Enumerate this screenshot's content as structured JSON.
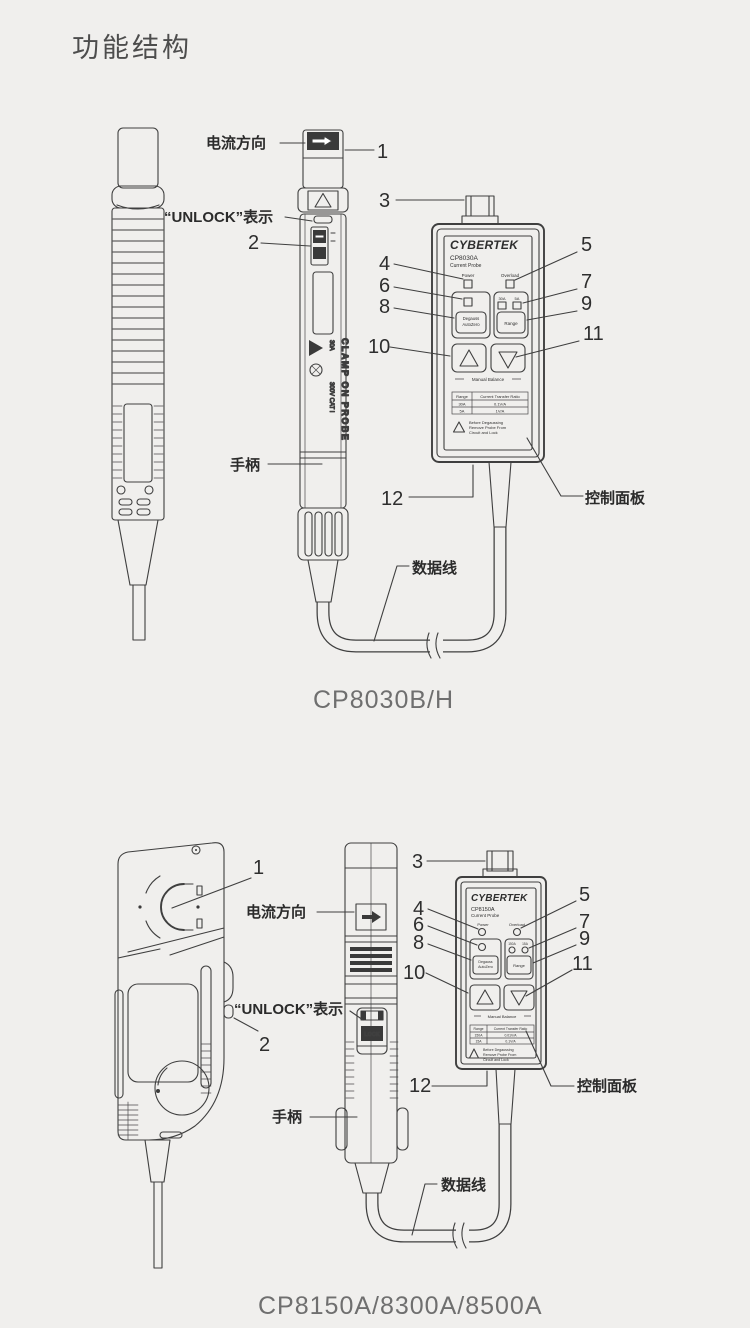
{
  "page": {
    "title": "功能结构"
  },
  "fig1": {
    "caption": "CP8030B/H",
    "labels": {
      "current_direction": "电流方向",
      "unlock": "“UNLOCK”表示",
      "handle": "手柄",
      "cable": "数据线",
      "control_panel": "控制面板"
    },
    "callouts": {
      "n1": "1",
      "n2": "2",
      "n3": "3",
      "n4": "4",
      "n5": "5",
      "n6": "6",
      "n7": "7",
      "n8": "8",
      "n9": "9",
      "n10": "10",
      "n11": "11",
      "n12": "12"
    },
    "probe": {
      "side_text": "CLAMP ON PROBE",
      "rating": "30A",
      "category": "300V CAT I"
    },
    "box": {
      "brand": "CYBERTEK",
      "model": "CP8030A",
      "type": "Current Probe",
      "power": "Power",
      "overload": "Overload",
      "range_led1": "30A",
      "range_led2": "5A",
      "degauss1": "Degauss",
      "degauss2": "AutoZero",
      "range_btn": "Range",
      "manual": "Manual Balance",
      "table": {
        "h1": "Range",
        "h2": "Current Transfer Ratio",
        "r1c1": "30A",
        "r1c2": "0.1V/A",
        "r2c1": "5A",
        "r2c2": "1V/A"
      },
      "warn1": "Before Degaussing",
      "warn2": "Remove Probe From",
      "warn3": "Circuit and Lock"
    }
  },
  "fig2": {
    "caption": "CP8150A/8300A/8500A",
    "labels": {
      "current_direction": "电流方向",
      "unlock": "“UNLOCK”表示",
      "handle": "手柄",
      "cable": "数据线",
      "control_panel": "控制面板"
    },
    "callouts": {
      "n1": "1",
      "n2": "2",
      "n3": "3",
      "n4": "4",
      "n5": "5",
      "n6": "6",
      "n7": "7",
      "n8": "8",
      "n9": "9",
      "n10": "10",
      "n11": "11",
      "n12": "12"
    },
    "probe": {
      "lock_text": "LOCK"
    },
    "box": {
      "brand": "CYBERTEK",
      "model": "CP8150A",
      "type": "Current Probe",
      "power": "Power",
      "overload": "Overload",
      "range_led1": "150A",
      "range_led2": "15A",
      "degauss1": "Degauss",
      "degauss2": "AutoZero",
      "range_btn": "Range",
      "manual": "Manual Balance",
      "table": {
        "h1": "Range",
        "h2": "Current Transfer Ratio",
        "r1c1": "150A",
        "r1c2": "0.01V/A",
        "r2c1": "15A",
        "r2c2": "0.1V/A"
      },
      "warn1": "Before Degaussing",
      "warn2": "Remove Probe From",
      "warn3": "Circuit and Lock"
    }
  }
}
